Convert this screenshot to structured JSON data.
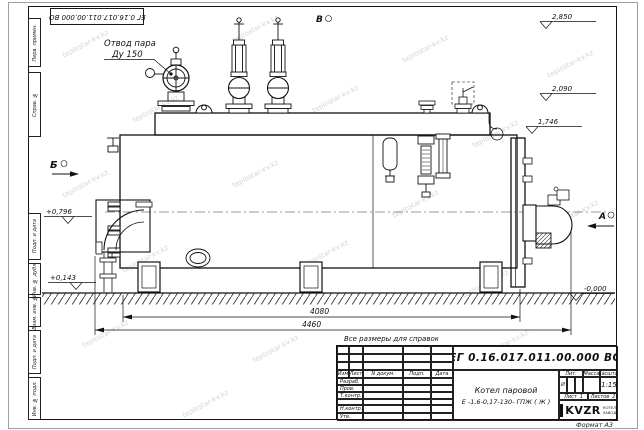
{
  "watermark": {
    "text": "teplostar-kv.kz"
  },
  "frame": {
    "top_code": "ЕГ 0.16.017.011.00.000  ВО",
    "format_note": "Формат А3",
    "margin_labels": [
      "Перв. примен.",
      "Справ. №",
      "Подп. и дата",
      "Инв. № дубл.",
      "Взам. инв. №",
      "Подп. и дата",
      "Инв. № подл."
    ]
  },
  "drawing": {
    "labels": {
      "steam_outlet_line1": "Отвод пара",
      "steam_outlet_line2": "Ду 150",
      "view_a": "А",
      "view_b": "Б",
      "view_v": "В",
      "note": "Все размеры для справок"
    },
    "elevations": [
      "2,850",
      "2,090",
      "1,746",
      "+0,796",
      "+0,143",
      "-0,000"
    ],
    "dimensions": [
      "4080",
      "4460"
    ]
  },
  "title_block": {
    "doc_number": "ЕГ 0.16.017.011.00.000  ВО",
    "product_name_line1": "Котел паровой",
    "product_name_line2": "Е -1,6-0,17-130- ГПЖ ( Ж )",
    "col_izm": "Изм",
    "col_list": "Лист",
    "col_doc": "N докум.",
    "col_podp": "Подп.",
    "col_data": "Дата",
    "row_razrab": "Разраб.",
    "row_prov": "Пров.",
    "row_tkontr": "Т.контр.",
    "row_nkontr": "Н.контр.",
    "row_utv": "Утв.",
    "litera_label": "Лит.",
    "mass_label": "Масса",
    "scale_label": "Масштаб",
    "litera": "И",
    "scale": "1:15",
    "sheet_label": "Лист",
    "sheet_num": "1",
    "sheets_label": "Листов",
    "sheets_num": "2",
    "logo_text": "KVZR",
    "logo_sub1": "КОТЕЛЬНЫЙ",
    "logo_sub2": "ЗАВОД РЗР"
  }
}
